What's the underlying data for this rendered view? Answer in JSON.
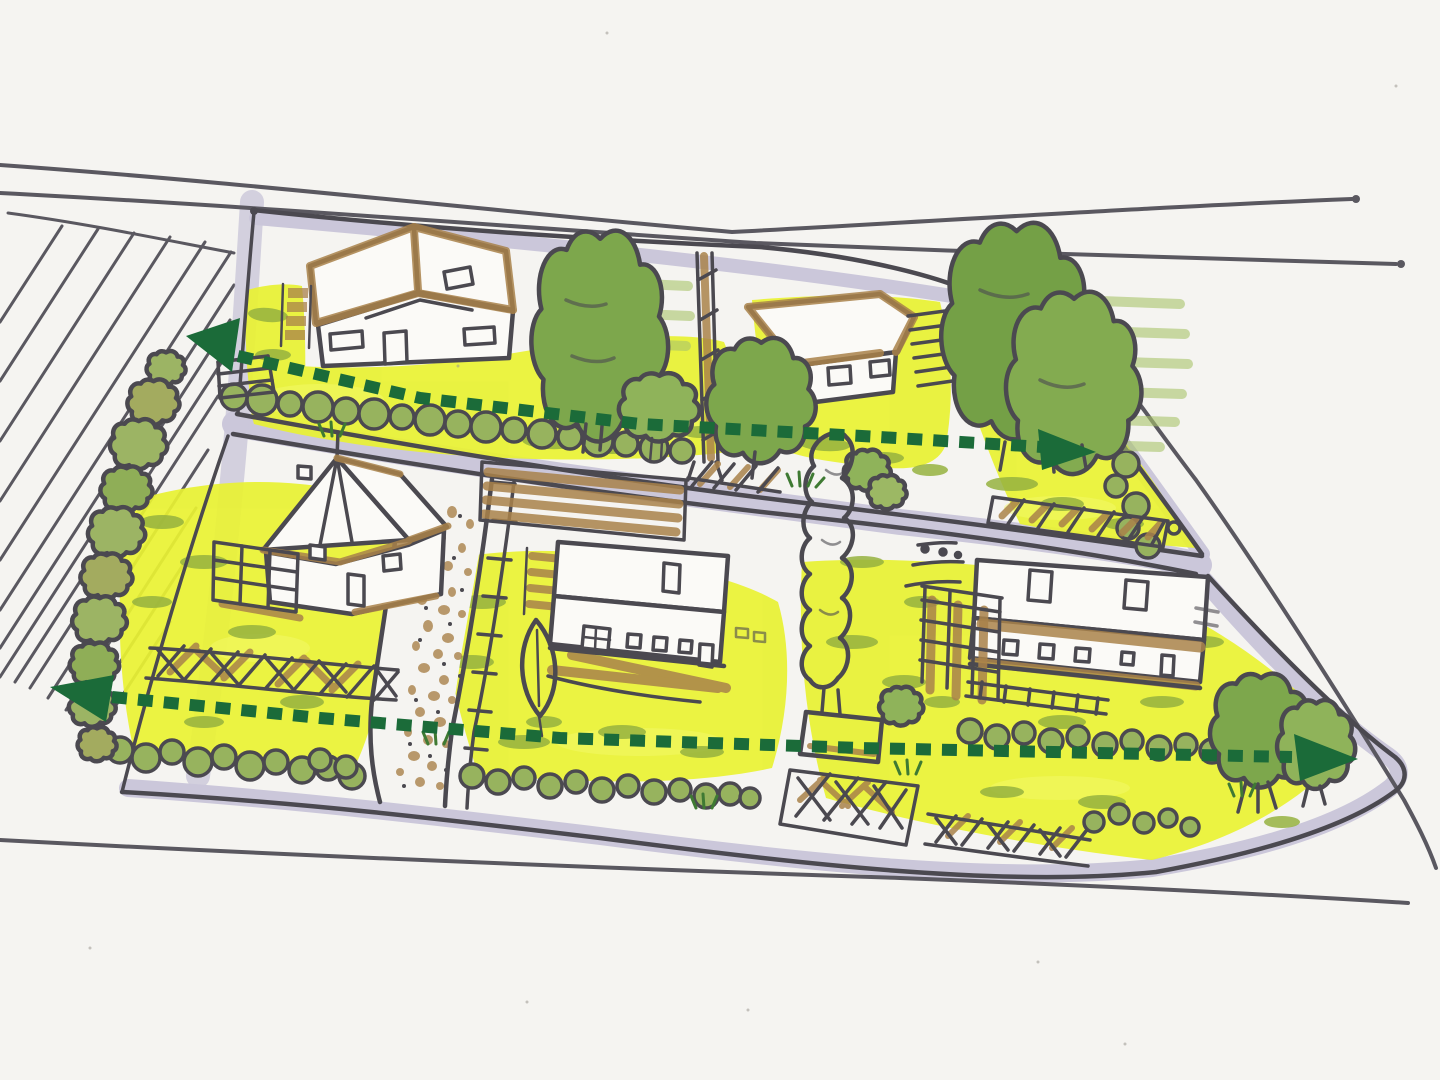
{
  "meta": {
    "title": "Hand-drawn marker sketch: neighborhood block site plan with green corridor arrows",
    "medium": "ink and marker on paper"
  },
  "colors": {
    "paper": "#f5f4f1",
    "ink": "#4b4950",
    "road_line": "#5a5860",
    "road_shade": "#cbc7da",
    "tan": "#d9c2a0",
    "lawn": "#e9f233",
    "lawn_light": "#f4f969",
    "grass": "#95b13f",
    "tuft": "#3f7a33",
    "tree": "#7da74c",
    "tree_light": "#a9c46b",
    "tree_dark": "#74a046",
    "tree_olive": "#9cb464",
    "hedge": "#97b35e",
    "brown": "#a9824a",
    "house": "#fbfaf7",
    "arrow": "#1b6b39"
  },
  "scene": {
    "field": {
      "name": "plowed field",
      "furrow_count": 14
    },
    "roads": [
      {
        "id": "top-road",
        "name": "top road"
      },
      {
        "id": "east-road",
        "name": "road leaving to the east"
      },
      {
        "id": "right-road",
        "name": "diagonal road on the right"
      },
      {
        "id": "bottom-road",
        "name": "bottom road"
      },
      {
        "id": "middle-road",
        "name": "residential street between the two rows"
      }
    ],
    "blocks": [
      {
        "id": "upper-block",
        "houses": 2,
        "hedgerows": 2,
        "large_trees": 5
      },
      {
        "id": "lower-block",
        "houses": 3,
        "hedgerows": 4,
        "large_trees": 5
      }
    ],
    "houses": [
      {
        "id": "house-a",
        "type": "cross-gable house, upper left"
      },
      {
        "id": "house-b",
        "type": "hip-roof house, upper right"
      },
      {
        "id": "house-c",
        "type": "steep-gable house with porch, lower left"
      },
      {
        "id": "house-d",
        "type": "two-storey house with carport, lower middle"
      },
      {
        "id": "house-e",
        "type": "long two-storey house with trellis, lower right"
      }
    ],
    "features": [
      {
        "id": "gravel-path",
        "name": "dotted gravel footpath"
      },
      {
        "id": "pole",
        "name": "utility pole"
      },
      {
        "id": "lattice-fences",
        "name": "crosshatched lattice fences",
        "count": 3
      },
      {
        "id": "trellis-bar",
        "name": "slatted screen along street"
      },
      {
        "id": "tan-edge",
        "name": "tan path along left edge of block"
      }
    ],
    "arrows": [
      {
        "id": "upper-corridor",
        "name": "dashed green corridor arrow across upper block",
        "style": "dashed",
        "heads": "both ends"
      },
      {
        "id": "lower-corridor",
        "name": "dashed green corridor arrow across lower block",
        "style": "dashed",
        "heads": "both ends"
      }
    ]
  }
}
